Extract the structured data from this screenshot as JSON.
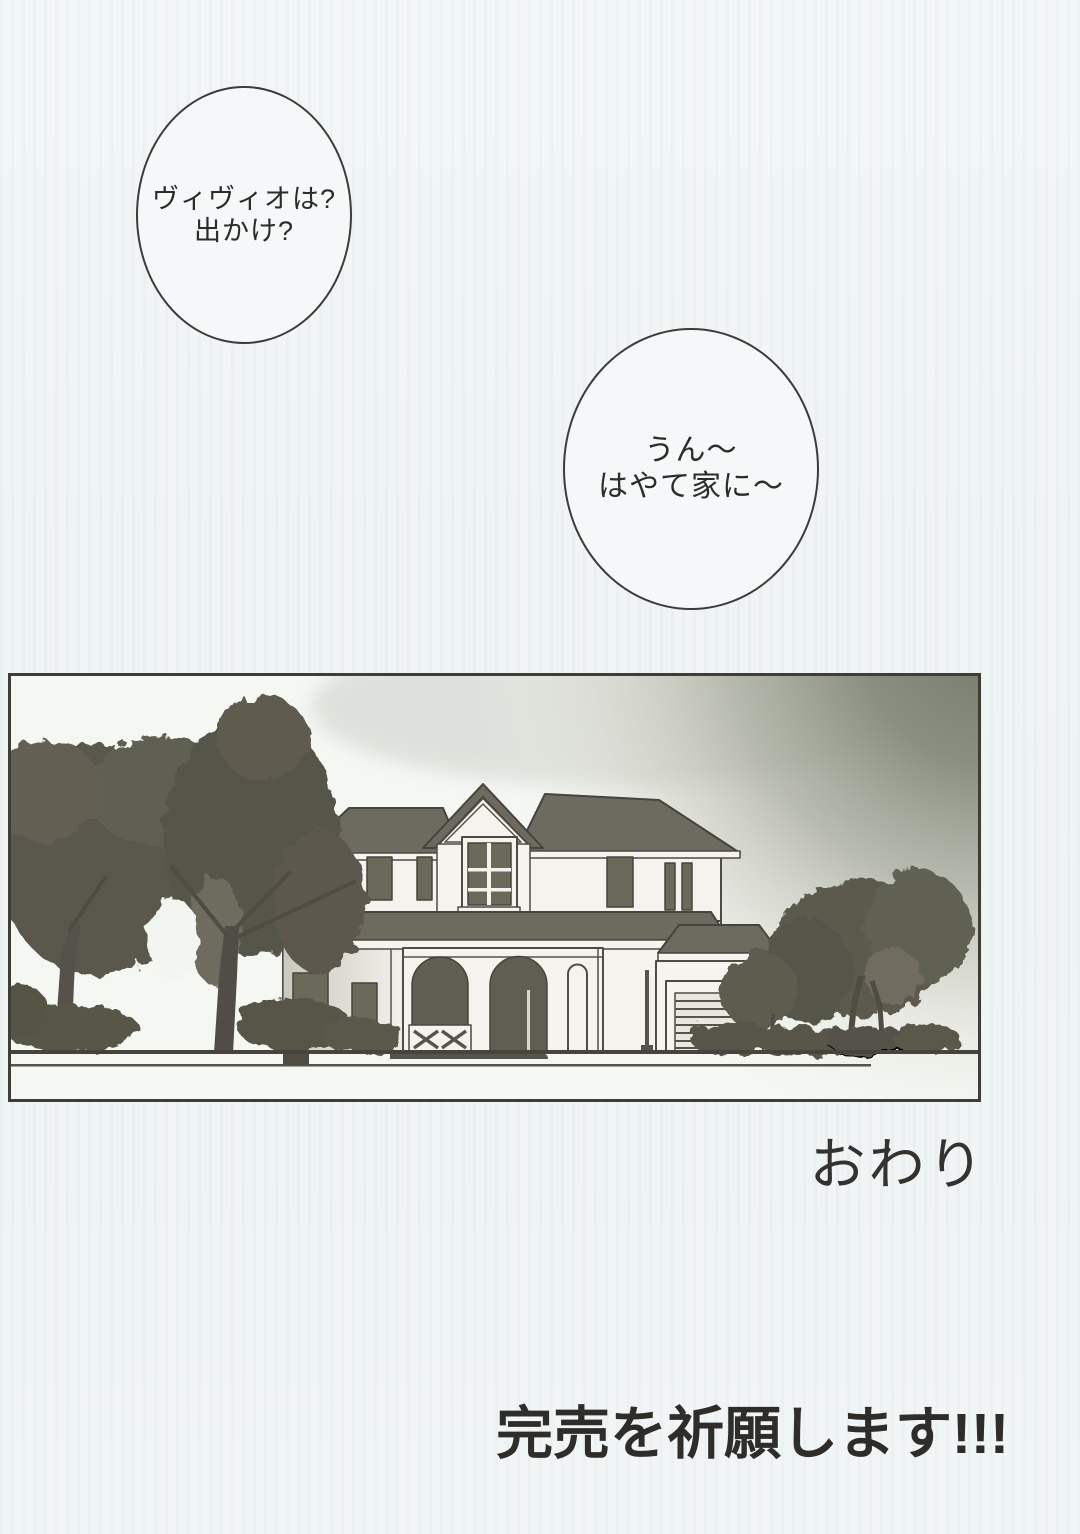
{
  "page": {
    "background": "#f2f5f6"
  },
  "speech_bubbles": [
    {
      "lines": [
        "ヴィヴィオは?",
        "出かけ?"
      ]
    },
    {
      "lines": [
        "うん〜",
        "はやて家に〜"
      ]
    }
  ],
  "captions": {
    "the_end": "おわり",
    "sellout_wish": "完売を祈願します!!!"
  },
  "illustration": {
    "subject": "two-story house with arched porch, garage and trees",
    "colors": {
      "ink": "#46443c",
      "wall": "#f4f3ed",
      "roof": "#6d6a5f",
      "window": "#6b6959",
      "foliage": "#56544a",
      "sky_dark_corner": "#777b6e",
      "paper": "#f5f7f3"
    }
  }
}
